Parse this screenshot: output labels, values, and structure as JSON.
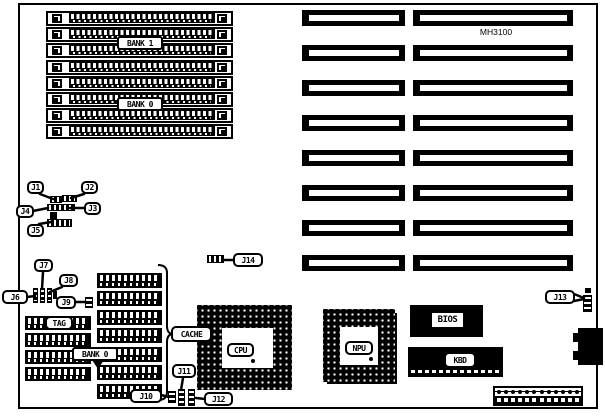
{
  "board": {
    "model_label": "MH3100"
  },
  "labels": {
    "bank1": "BANK 1",
    "bank0_simm": "BANK 0",
    "bank0_dram": "BANK 0",
    "tag": "TAG",
    "cache": "CACHE",
    "cpu": "CPU",
    "npu": "NPU",
    "bios": "BIOS",
    "kbd": "KBD"
  },
  "jumpers": [
    {
      "label": "J1"
    },
    {
      "label": "J2"
    },
    {
      "label": "J3"
    },
    {
      "label": "J4"
    },
    {
      "label": "J5"
    },
    {
      "label": "J6"
    },
    {
      "label": "J7"
    },
    {
      "label": "J8"
    },
    {
      "label": "J9"
    },
    {
      "label": "J10"
    },
    {
      "label": "J11"
    },
    {
      "label": "J12"
    },
    {
      "label": "J13"
    },
    {
      "label": "J14"
    }
  ],
  "memory": {
    "simm_socket_count": 8
  },
  "expansion": {
    "slot_rows": 8,
    "slot_columns": 2
  },
  "cache_chip_count": 7,
  "dram_chip_rows": 4,
  "power_connector_pins": 12
}
